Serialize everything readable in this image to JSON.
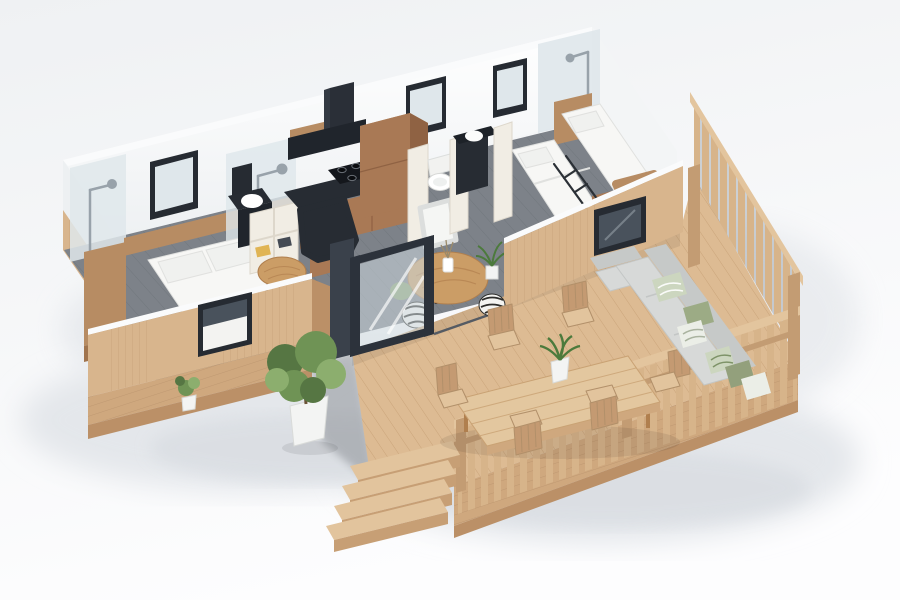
{
  "meta": {
    "type": "3d-floorplan-render",
    "description": "Isometric 3D cutaway render of a small two-bedroom holiday home (mobile home) with a large wraparound wooden terrace, outdoor dining set, corner lounge sofa, potted plants and entry steps.",
    "visible_text": "none"
  },
  "labels": {
    "scene": "3D floor plan render of holiday home with wooden deck",
    "masterBedroom": "Master bedroom with double bed and en-suite shower",
    "kitchen": "Kitchen with black countertop and hood",
    "bathroom": "Shower room and WC",
    "kidsRoom": "Bunk-bed bedroom with shower",
    "livingArea": "Dining nook with round table and poufs",
    "deck": "Raised wooden terrace",
    "outdoorDining": "Outdoor dining table with six chairs",
    "loungeSofa": "Outdoor corner sofa with cushions",
    "plants": "Potted plants",
    "steps": "Wooden entry steps",
    "glassDoors": "Open sliding glass doors"
  },
  "palette": {
    "bgTop": "#eff1f3",
    "bgBottom": "#fdfdfe",
    "shadow1": "#e4e7eb",
    "shadow2": "#d9dde2",
    "wallWhite": "#ffffff",
    "wallShade": "#edf0f2",
    "wallSide": "#f3f5f6",
    "wallTop": "#fafbfc",
    "floorGray": "#7d8289",
    "floorLine": "#676c73",
    "deckWood": "#ddbb93",
    "deckLine": "#c69f74",
    "fascia": "#cfa87e",
    "fasciaLine": "#b8916a",
    "fascia2": "#bb9067",
    "railWood": "#d7b48a",
    "railCap": "#e3c59e",
    "railPost": "#c39c73",
    "stepWood": "#e2c49d",
    "stepRiser": "#c79f75",
    "cladWood": "#d8b58d",
    "cladLine": "#c29b72",
    "frameBlack": "#262b32",
    "glassBlue": "#cdd9df",
    "glassDark": "#49525c",
    "glassPale": "#dfe7eb",
    "counterBlack": "#272c33",
    "hoodBlack": "#20252c",
    "kitchenWood": "#a97955",
    "kitchenWoodDark": "#8f6243",
    "kitchenWoodTop": "#c49a72",
    "woodAccent": "#b78c63",
    "woodAccentDark": "#a0744e",
    "cream": "#f1ede4",
    "creamShade": "#ddd7cb",
    "creamTop": "#faf8f2",
    "bedWhite": "#f7f7f5",
    "bedEdge": "#e0e1df",
    "pillowWhite": "#f0f1ef",
    "sofaGray": "#d7d9d8",
    "sofaDark": "#c6c9c8",
    "sage": "#9cab85",
    "sagePale": "#ccd6bf",
    "olive": "#93a07c",
    "creamPillow": "#ebeee7",
    "green1": "#567643",
    "green2": "#6f9355",
    "green3": "#8cae6e",
    "potWhite": "#f3f4f3",
    "potEdge": "#d9dbd9",
    "chrome": "#98a2aa",
    "tableWood": "#cb9d66",
    "tableWoodDark": "#b07f4e",
    "zebraWhite": "#f4f4f1",
    "zebraBlack": "#2d2d2b",
    "charcoal": "#3a414b",
    "threshold": "#555b63"
  }
}
